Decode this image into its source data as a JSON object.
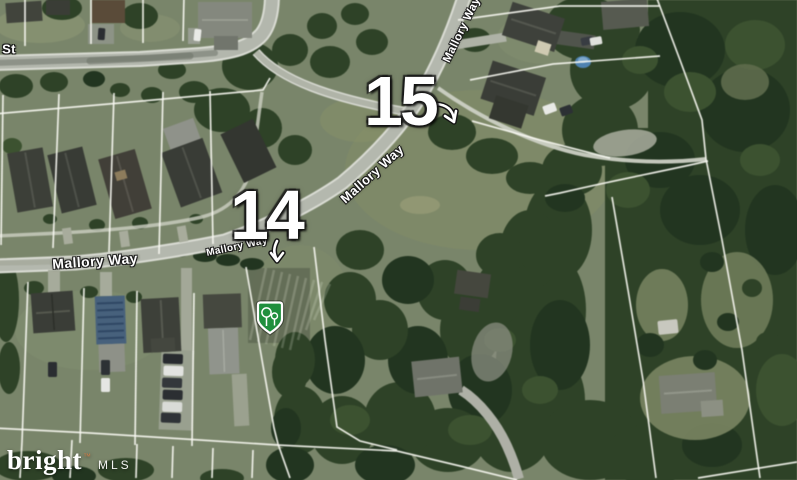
{
  "map": {
    "imagery": "satellite",
    "street_labels": [
      {
        "id": "st",
        "text": "St"
      },
      {
        "id": "mallory-way-north",
        "text": "Mallory Way"
      },
      {
        "id": "mallory-way-bend",
        "text": "Mallory Way"
      },
      {
        "id": "mallory-way-center",
        "text": "Mallory Way"
      },
      {
        "id": "mallory-way-west",
        "text": "Mallory Way"
      }
    ],
    "lot_markers": [
      {
        "label": "15",
        "arrow": "curved-arrow-southeast-icon"
      },
      {
        "label": "14",
        "arrow": "arrow-down-icon"
      }
    ],
    "poi_marker": {
      "icon": "tree-badge-icon",
      "shape": "green-shield",
      "color": "#1f8f3d"
    }
  },
  "watermark": {
    "brand": "bright",
    "trademark": "™",
    "org": "MLS"
  },
  "colors": {
    "street_label_text": "#ffffff",
    "lot_number_text": "#ffffff",
    "parcel_line": "#f6f6f0",
    "road_gray": "#b4b8ae",
    "badge_green": "#1f8f3d",
    "woods_green": "#2e4227",
    "grass_green": "#79856a"
  }
}
